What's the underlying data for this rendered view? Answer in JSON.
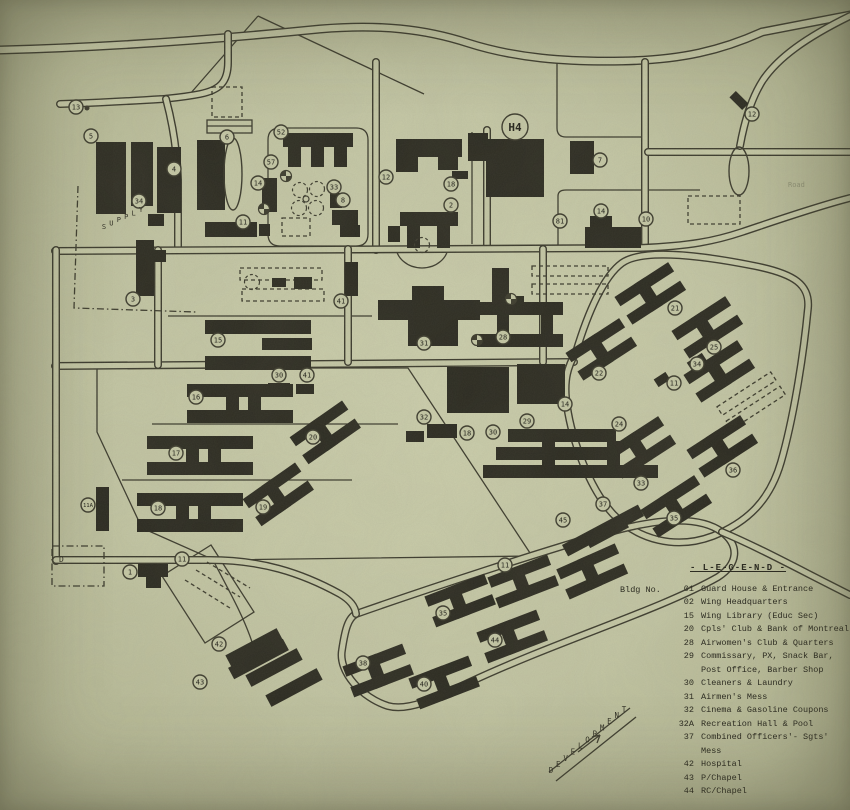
{
  "legend": {
    "title": "- L-E-G-E-N-D -",
    "heading": "Bldg No.",
    "entries": [
      {
        "no": "01",
        "name": "Guard House & Entrance"
      },
      {
        "no": "02",
        "name": "Wing Headquarters"
      },
      {
        "no": "15",
        "name": "Wing Library (Educ Sec)"
      },
      {
        "no": "20",
        "name": "Cpls' Club & Bank of Montreal"
      },
      {
        "no": "28",
        "name": "Airwomen's Club & Quarters"
      },
      {
        "no": "29",
        "name": "Commissary, PX, Snack Bar,\nPost Office, Barber Shop"
      },
      {
        "no": "30",
        "name": "Cleaners & Laundry"
      },
      {
        "no": "31",
        "name": "Airmen's Mess"
      },
      {
        "no": "32",
        "name": "Cinema & Gasoline Coupons"
      },
      {
        "no": "32A",
        "name": "Recreation Hall & Pool"
      },
      {
        "no": "37",
        "name": "Combined Officers'- Sgts' Mess"
      },
      {
        "no": "42",
        "name": "Hospital"
      },
      {
        "no": "43",
        "name": "P/Chapel"
      },
      {
        "no": "44",
        "name": "RC/Chapel"
      }
    ]
  },
  "colors": {
    "paper": "#c3c6a4",
    "road_fill": "#c6c9a7",
    "ink": "#3b3a2d",
    "building": "#2b2a21"
  },
  "map": {
    "labels": [
      {
        "text": "SUPPLY",
        "x1": 104,
        "y1": 229,
        "x2": 141,
        "y2": 212,
        "size": 7
      },
      {
        "text": "DEVELOPMENT",
        "x1": 551,
        "y1": 773,
        "x2": 624,
        "y2": 712,
        "size": 7.5
      },
      {
        "text": "Road",
        "x": 788,
        "y": 187,
        "size": 7,
        "opacity": 0.3
      },
      {
        "text": "D",
        "x": 59,
        "y": 562,
        "size": 8
      }
    ],
    "roads": [
      {
        "d": "M0,50 C120,47 230,38 320,29 C380,24 425,29 468,43 C515,58 565,62 622,61 C682,60 722,50 762,32 L850,15",
        "w": 9
      },
      {
        "d": "M228,34 L228,62 C228,82 220,90 200,94 C185,97 172,98 163,99 C130,101 95,103 60,104"
      },
      {
        "d": "M166,99 C173,125 177,150 178,180 L178,250"
      },
      {
        "d": "M376,62 L376,250"
      },
      {
        "d": "M487,130 L487,248"
      },
      {
        "d": "M645,62 L645,248"
      },
      {
        "d": "M648,152 L850,152"
      },
      {
        "d": "M850,16 C805,38 778,58 763,80 C752,97 745,118 740,146"
      },
      {
        "d": "M55,251 L640,248 C690,246 715,241 742,232 C775,221 815,207 850,198"
      },
      {
        "d": "M55,366 L574,362"
      },
      {
        "d": "M56,250 L56,561"
      },
      {
        "d": "M158,250 L158,365"
      },
      {
        "d": "M348,249 L348,362"
      },
      {
        "d": "M543,249 L543,362"
      },
      {
        "d": "M576,352 C588,312 604,276 622,263 C640,250 690,253 755,266 C795,274 810,285 808,308 C803,360 793,420 781,462 C770,500 748,522 713,536 C676,550 638,540 613,514 C589,488 572,440 567,406 C563,380 568,366 576,352 Z"
      },
      {
        "d": "M356,614 C430,588 540,552 610,532 C660,518 700,516 722,532 C740,546 738,564 718,577 C660,610 560,640 470,682 C440,696 410,712 388,706 C362,698 338,672 342,650 C345,630 348,618 356,614 Z"
      },
      {
        "d": "M56,560 L210,560 C260,560 300,572 340,594 C350,600 355,606 356,614"
      },
      {
        "d": "M722,532 C760,548 800,570 850,595"
      }
    ],
    "thin_lines": [
      "M557,62 L557,128 Q557,137 566,137 L641,137",
      "M472,132 L472,244",
      "M558,248 L558,196 Q558,190 566,190 L700,190",
      "M190,94 L258,16",
      "M258,16 L424,94",
      "M268,140 Q268,128 280,128 L356,128 Q368,128 368,140 L368,234 Q368,246 356,246 L280,246 Q268,246 268,234 Z",
      "M168,316 L372,316",
      "M97,368 L408,368 L532,556 L214,560 L142,528 L97,432 Z",
      "M152,424 L398,424",
      "M122,480 L352,480",
      "M211,545 L254,612 L205,643 L162,576 Z",
      "M214,562 C232,596 244,618 252,642",
      "M396,246 A26,22 0 0 0 448,246",
      "M207,126 L252,126",
      "M630,708 L549,772",
      "M636,717 L556,781",
      "M578,752 L600,735",
      "M600,735 L592,737",
      "M600,735 L597,743"
    ],
    "thin_rects": [
      [
        207,
        120,
        45,
        13
      ]
    ],
    "dashed": [
      {
        "d": "M78,186 L74,308 L196,312",
        "dot": true
      },
      {
        "d": "M52,546 h52 v40 h-52 Z",
        "dot": true
      },
      {
        "d": "M212,87 h30 v30 h-30 Z"
      },
      {
        "d": "M240,268 h82 v12 h-82 Z"
      },
      {
        "d": "M242,289 h82 v12 h-82 Z"
      },
      {
        "d": "M282,218 h28 v18 h-28 Z"
      },
      {
        "d": "M532,266 h76 v10 h-76 Z"
      },
      {
        "d": "M532,284 h76 v10 h-76 Z"
      },
      {
        "d": "M688,196 h52 v28 h-52 Z"
      },
      {
        "d": "M720,387 h64 v10 h-64 Z",
        "t": "rotate(-33 752 402)"
      },
      {
        "d": "M720,404 h64 v10 h-64 Z",
        "t": "rotate(-33 752 402)"
      },
      {
        "d": "M185,580 L230,608"
      },
      {
        "d": "M196,570 L240,597"
      },
      {
        "d": "M207,562 L250,588"
      }
    ],
    "buildings": [
      [
        96,
        142,
        30,
        72
      ],
      [
        131,
        142,
        22,
        64
      ],
      [
        157,
        147,
        24,
        66
      ],
      [
        148,
        214,
        16,
        12
      ],
      [
        136,
        240,
        18,
        56
      ],
      [
        154,
        250,
        12,
        12
      ],
      [
        197,
        140,
        28,
        70
      ],
      [
        205,
        222,
        52,
        15
      ],
      [
        259,
        224,
        11,
        12
      ],
      [
        283,
        133,
        70,
        14
      ],
      [
        288,
        147,
        13,
        20
      ],
      [
        311,
        147,
        13,
        20
      ],
      [
        334,
        147,
        13,
        20
      ],
      [
        262,
        178,
        15,
        34
      ],
      [
        330,
        193,
        12,
        15
      ],
      [
        332,
        210,
        26,
        15
      ],
      [
        340,
        225,
        20,
        12
      ],
      [
        272,
        278,
        14,
        9
      ],
      [
        294,
        277,
        18,
        12
      ],
      [
        396,
        139,
        66,
        18
      ],
      [
        396,
        157,
        22,
        15
      ],
      [
        438,
        157,
        20,
        13
      ],
      [
        452,
        171,
        16,
        8
      ],
      [
        400,
        212,
        58,
        14
      ],
      [
        407,
        226,
        13,
        22
      ],
      [
        437,
        226,
        13,
        22
      ],
      [
        388,
        226,
        12,
        16
      ],
      [
        486,
        139,
        58,
        58
      ],
      [
        468,
        133,
        20,
        28
      ],
      [
        570,
        141,
        24,
        33
      ],
      [
        585,
        227,
        56,
        21
      ],
      [
        590,
        216,
        22,
        11
      ],
      [
        730,
        96,
        18,
        9,
        45
      ],
      [
        345,
        262,
        13,
        34
      ],
      [
        205,
        320,
        106,
        14
      ],
      [
        262,
        338,
        50,
        12
      ],
      [
        205,
        356,
        106,
        14
      ],
      [
        412,
        286,
        32,
        14
      ],
      [
        378,
        300,
        102,
        20
      ],
      [
        408,
        320,
        50,
        26
      ],
      [
        492,
        268,
        17,
        30
      ],
      [
        492,
        296,
        32,
        12
      ],
      [
        477,
        302,
        86,
        13
      ],
      [
        477,
        334,
        86,
        13
      ],
      [
        497,
        302,
        12,
        45
      ],
      [
        541,
        302,
        12,
        45
      ],
      [
        447,
        367,
        62,
        46
      ],
      [
        517,
        364,
        48,
        40
      ],
      [
        427,
        424,
        30,
        14
      ],
      [
        406,
        431,
        18,
        11
      ],
      [
        508,
        429,
        108,
        13
      ],
      [
        496,
        447,
        122,
        13
      ],
      [
        483,
        465,
        175,
        13
      ],
      [
        542,
        429,
        13,
        49
      ],
      [
        607,
        441,
        13,
        37
      ],
      [
        268,
        383,
        22,
        11
      ],
      [
        296,
        384,
        18,
        10
      ],
      [
        96,
        487,
        13,
        44
      ],
      [
        138,
        564,
        30,
        13
      ],
      [
        146,
        577,
        15,
        11
      ],
      [
        225,
        641,
        58,
        13,
        -28
      ],
      [
        245,
        661,
        58,
        13,
        -28
      ],
      [
        265,
        681,
        58,
        13,
        -28
      ],
      [
        252,
        628,
        13,
        62,
        62
      ],
      [
        688,
        357,
        18,
        10,
        -33
      ],
      [
        655,
        375,
        14,
        9,
        -33
      ],
      [
        560,
        524,
        86,
        13,
        -28
      ],
      [
        600,
        510,
        13,
        44,
        62
      ]
    ],
    "h_units": [
      [
        650,
        293,
        -33
      ],
      [
        707,
        327,
        -33
      ],
      [
        601,
        349,
        -33
      ],
      [
        719,
        371,
        -33
      ],
      [
        640,
        447,
        -33
      ],
      [
        722,
        446,
        -33
      ],
      [
        676,
        506,
        -33
      ],
      [
        460,
        600,
        -21
      ],
      [
        512,
        636,
        -21
      ],
      [
        378,
        670,
        -21
      ],
      [
        444,
        682,
        -21
      ],
      [
        523,
        581,
        -21
      ],
      [
        592,
        571,
        -24
      ],
      [
        325,
        432,
        -35
      ],
      [
        278,
        494,
        -35
      ]
    ],
    "big_h_units": [
      [
        240,
        403
      ],
      [
        200,
        455
      ],
      [
        190,
        512
      ]
    ],
    "symbols": {
      "pinwheels": [
        [
          286,
          176
        ],
        [
          264,
          209
        ],
        [
          477,
          340
        ],
        [
          511,
          299
        ]
      ],
      "dashed_circles": [
        [
          300,
          190
        ],
        [
          317,
          189
        ],
        [
          299,
          208
        ],
        [
          316,
          208
        ],
        [
          422,
          245
        ],
        [
          252,
          282
        ]
      ],
      "small_circles": [
        [
          306,
          199
        ]
      ],
      "dots": [
        [
          87,
          108
        ]
      ],
      "ellipses": [
        [
          233,
          174,
          9,
          36
        ],
        [
          739,
          171,
          10,
          24
        ]
      ]
    },
    "markers": [
      [
        76,
        107,
        "13"
      ],
      [
        91,
        136,
        "5"
      ],
      [
        174,
        169,
        "4"
      ],
      [
        139,
        201,
        "34"
      ],
      [
        133,
        299,
        "3"
      ],
      [
        227,
        137,
        "6"
      ],
      [
        243,
        222,
        "11"
      ],
      [
        281,
        132,
        "52"
      ],
      [
        271,
        162,
        "57"
      ],
      [
        258,
        183,
        "14"
      ],
      [
        334,
        187,
        "33"
      ],
      [
        343,
        200,
        "8"
      ],
      [
        386,
        177,
        "12"
      ],
      [
        451,
        184,
        "18"
      ],
      [
        451,
        205,
        "2"
      ],
      [
        600,
        160,
        "7"
      ],
      [
        560,
        221,
        "81"
      ],
      [
        601,
        211,
        "14"
      ],
      [
        646,
        219,
        "10"
      ],
      [
        752,
        114,
        "12"
      ],
      [
        341,
        301,
        "41"
      ],
      [
        218,
        340,
        "15"
      ],
      [
        424,
        343,
        "31"
      ],
      [
        503,
        337,
        "28"
      ],
      [
        675,
        308,
        "21"
      ],
      [
        599,
        373,
        "22"
      ],
      [
        714,
        347,
        "25"
      ],
      [
        697,
        364,
        "34"
      ],
      [
        674,
        383,
        "11"
      ],
      [
        619,
        424,
        "24"
      ],
      [
        641,
        483,
        "33"
      ],
      [
        674,
        518,
        "35"
      ],
      [
        733,
        470,
        "36"
      ],
      [
        603,
        504,
        "37"
      ],
      [
        196,
        397,
        "16"
      ],
      [
        176,
        453,
        "17"
      ],
      [
        158,
        508,
        "18"
      ],
      [
        263,
        507,
        "19"
      ],
      [
        313,
        437,
        "20"
      ],
      [
        279,
        375,
        "30"
      ],
      [
        307,
        375,
        "41"
      ],
      [
        424,
        417,
        "32"
      ],
      [
        467,
        433,
        "18"
      ],
      [
        493,
        432,
        "30"
      ],
      [
        527,
        421,
        "29"
      ],
      [
        565,
        404,
        "14"
      ],
      [
        130,
        572,
        "1"
      ],
      [
        182,
        559,
        "11"
      ],
      [
        219,
        644,
        "42"
      ],
      [
        200,
        682,
        "43"
      ],
      [
        495,
        640,
        "44"
      ],
      [
        443,
        613,
        "35"
      ],
      [
        363,
        663,
        "38"
      ],
      [
        424,
        684,
        "40"
      ],
      [
        505,
        565,
        "11"
      ],
      [
        563,
        520,
        "45"
      ],
      [
        88,
        505,
        "11A"
      ]
    ],
    "big_marker": {
      "x": 515,
      "y": 127,
      "label": "H4",
      "r": 13
    }
  }
}
